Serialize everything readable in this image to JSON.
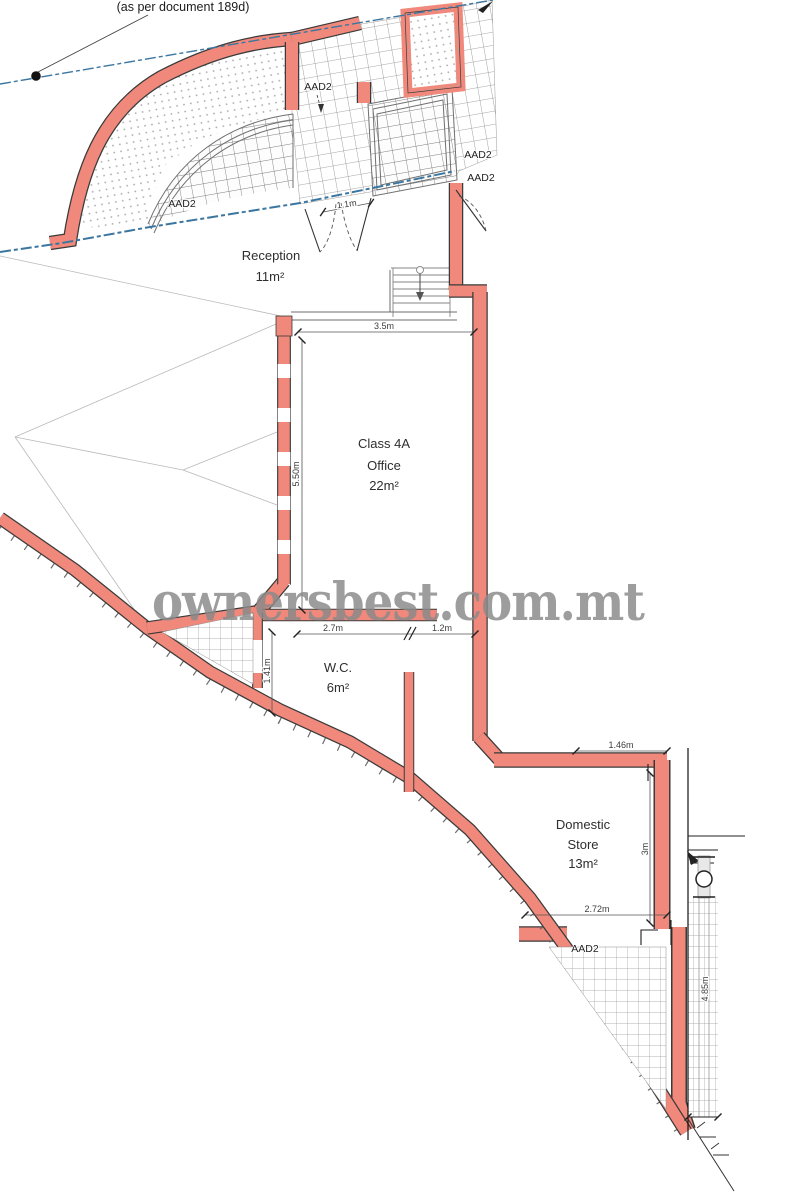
{
  "plan": {
    "annotation_note": "(as per document 189d)",
    "watermark": "ownersbest.com.mt"
  },
  "rooms": {
    "reception": {
      "name": "Reception",
      "area": "11m²"
    },
    "office": {
      "line1": "Class 4A",
      "line2": "Office",
      "line3": "22m²"
    },
    "wc": {
      "name": "W.C.",
      "area": "6m²"
    },
    "store": {
      "line1": "Domestic",
      "line2": "Store",
      "line3": "13m²"
    }
  },
  "door_labels": {
    "top_entrance": "AAD2",
    "arch_window": "AAD2",
    "right_upper": "AAD2",
    "right_lower": "AAD2",
    "store_door": "AAD2"
  },
  "dimensions": {
    "entrance_door": "1.1m",
    "office_width": "3.5m",
    "office_depth": "5.50m",
    "wc_width": "2.7m",
    "wc_passage": "1.2m",
    "wc_door": "1.41m",
    "store_top": "1.46m",
    "store_depth": "3m",
    "store_width": "2.72m",
    "side_strip": "4.85m"
  },
  "colors": {
    "wall": "#f0897b",
    "boundary": "#3a76a0",
    "watermark": "#8c8c8c"
  }
}
